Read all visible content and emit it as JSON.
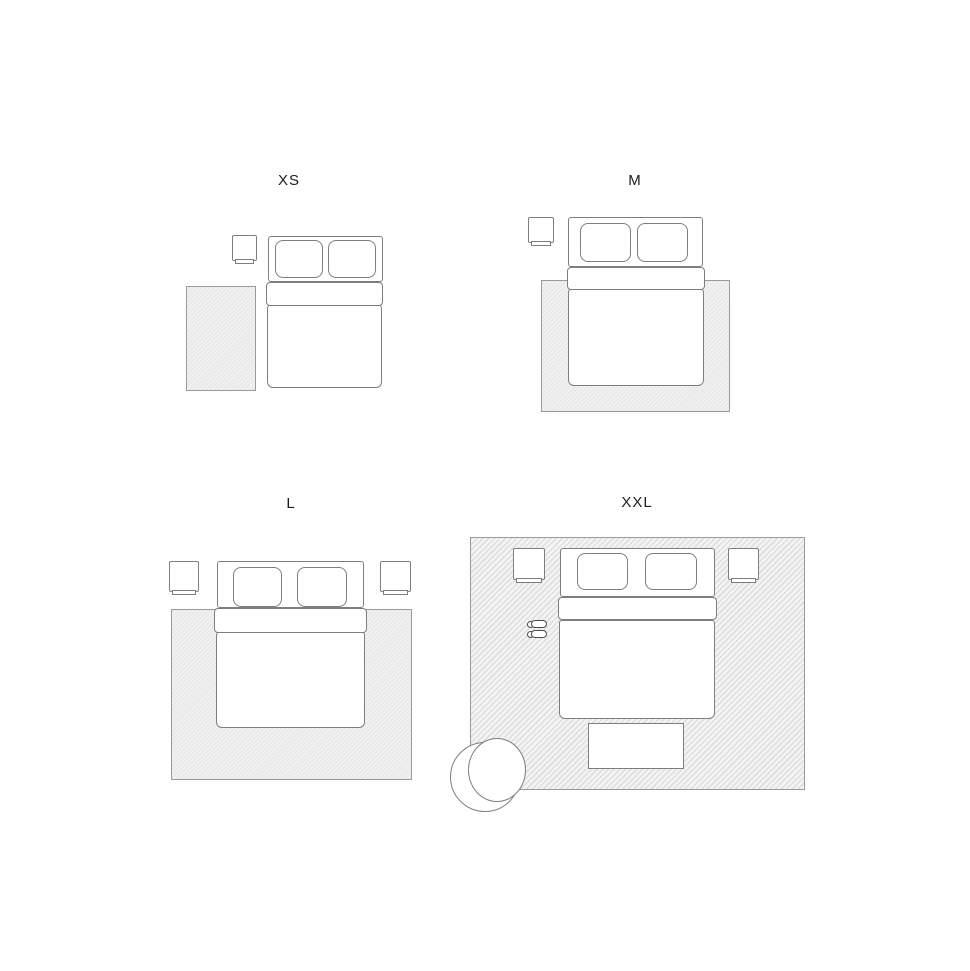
{
  "colors": {
    "page-bg": "#ffffff",
    "stroke": "#7e7e7e",
    "rug-fill": "#e9e9e9",
    "rug-border": "#9a9a9a",
    "label-color": "#1c1c1c",
    "slipper-stroke": "#4d4d4d"
  },
  "panels": [
    {
      "id": "xs",
      "label": "XS",
      "items": [
        "rug (side runner, left of bed)",
        "nightstand (left)",
        "double bed with two pillows"
      ]
    },
    {
      "id": "m",
      "label": "M",
      "items": [
        "rug (under lower two-thirds of bed)",
        "nightstand (left)",
        "double bed with two pillows"
      ]
    },
    {
      "id": "l",
      "label": "L",
      "items": [
        "rug (wide, under lower two-thirds of bed)",
        "nightstand (left)",
        "nightstand (right)",
        "double bed with two pillows"
      ]
    },
    {
      "id": "xxl",
      "label": "XXL",
      "items": [
        "rug (room-sized, under everything)",
        "nightstand (left)",
        "nightstand (right)",
        "double bed with two pillows",
        "slippers",
        "bench at foot of bed",
        "round armchair at bottom-left corner"
      ]
    }
  ]
}
